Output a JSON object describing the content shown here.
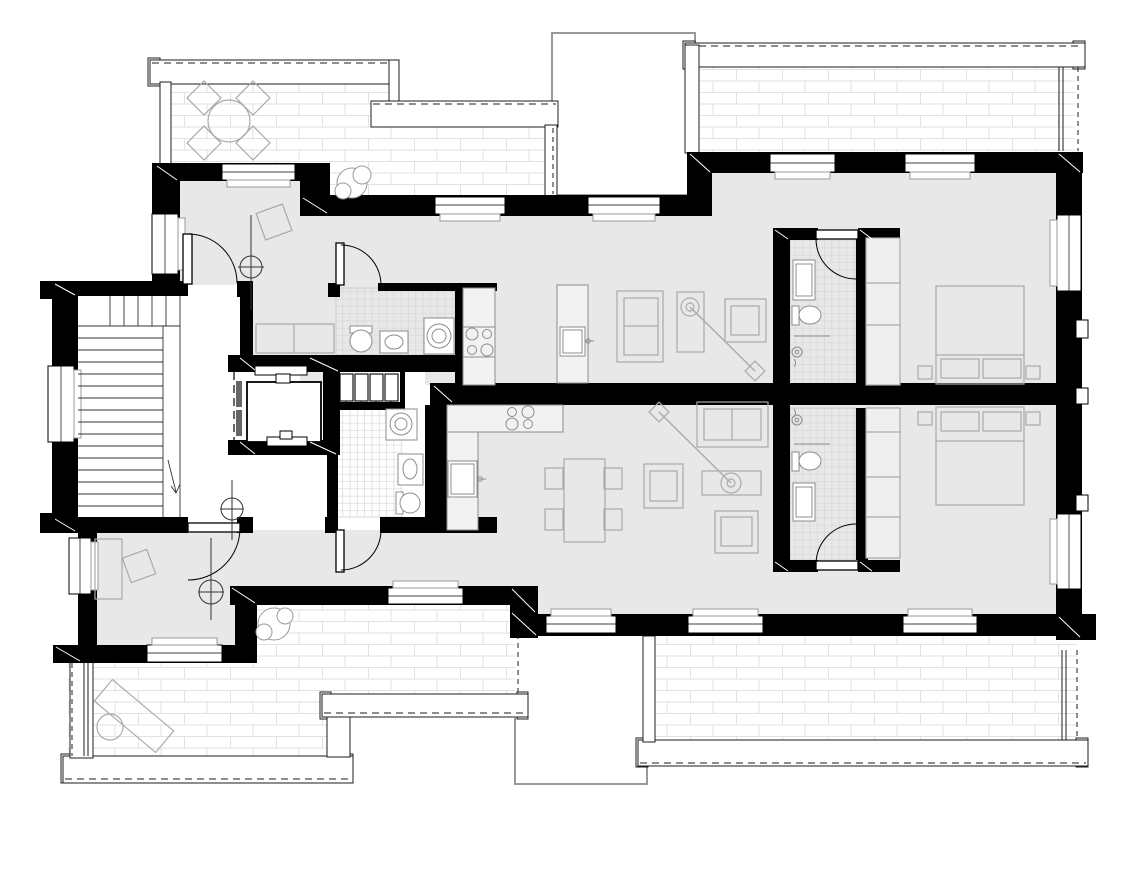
{
  "colors": {
    "background": "#ffffff",
    "wall": "#000000",
    "floor": "#e8e8e8",
    "tile_line": "#d6d6d6",
    "brick_line": "#e2e2e2",
    "furniture_line": "#aaaaaa",
    "fixture_line": "#8c8c8c",
    "void_outline": "#9a9a9a",
    "railing_line": "#1c1c1c",
    "symbol_line": "#333333",
    "window_frame": "#000000",
    "sill_line": "#9a9a9a",
    "corner_mark": "#ffffff"
  },
  "plan": {
    "drawing_type": "residential-floor-plan",
    "common_areas": [
      "stairwell",
      "elevator",
      "lobby"
    ],
    "apartments": [
      {
        "id": "upper",
        "rooms": [
          "entry-hall",
          "bathroom",
          "utility-closet",
          "kitchen",
          "living-area",
          "corridor",
          "bedroom",
          "en-suite-bathroom",
          "terrace-northwest",
          "terrace-northeast"
        ]
      },
      {
        "id": "lower",
        "rooms": [
          "entry-room",
          "hallway",
          "bathroom",
          "kitchen",
          "living-dining-area",
          "bedroom",
          "en-suite-bathroom",
          "terrace-southwest",
          "terrace-southeast"
        ]
      }
    ],
    "element_counts": {
      "windows": 15,
      "door_swings": 6,
      "beds": 2,
      "wardrobes": 2,
      "toilets": 4,
      "sinks": 6,
      "washing_machines": 2,
      "hobs": 2,
      "kitchen_islands": 2,
      "sofas": 2,
      "armchairs": 3,
      "dining_tables": 1,
      "terrace_tables": 2,
      "loungers": 1,
      "plants": 2,
      "ceiling_light_symbols": 3,
      "terraces": 4,
      "voids": 2,
      "stair_flights": 2
    }
  }
}
